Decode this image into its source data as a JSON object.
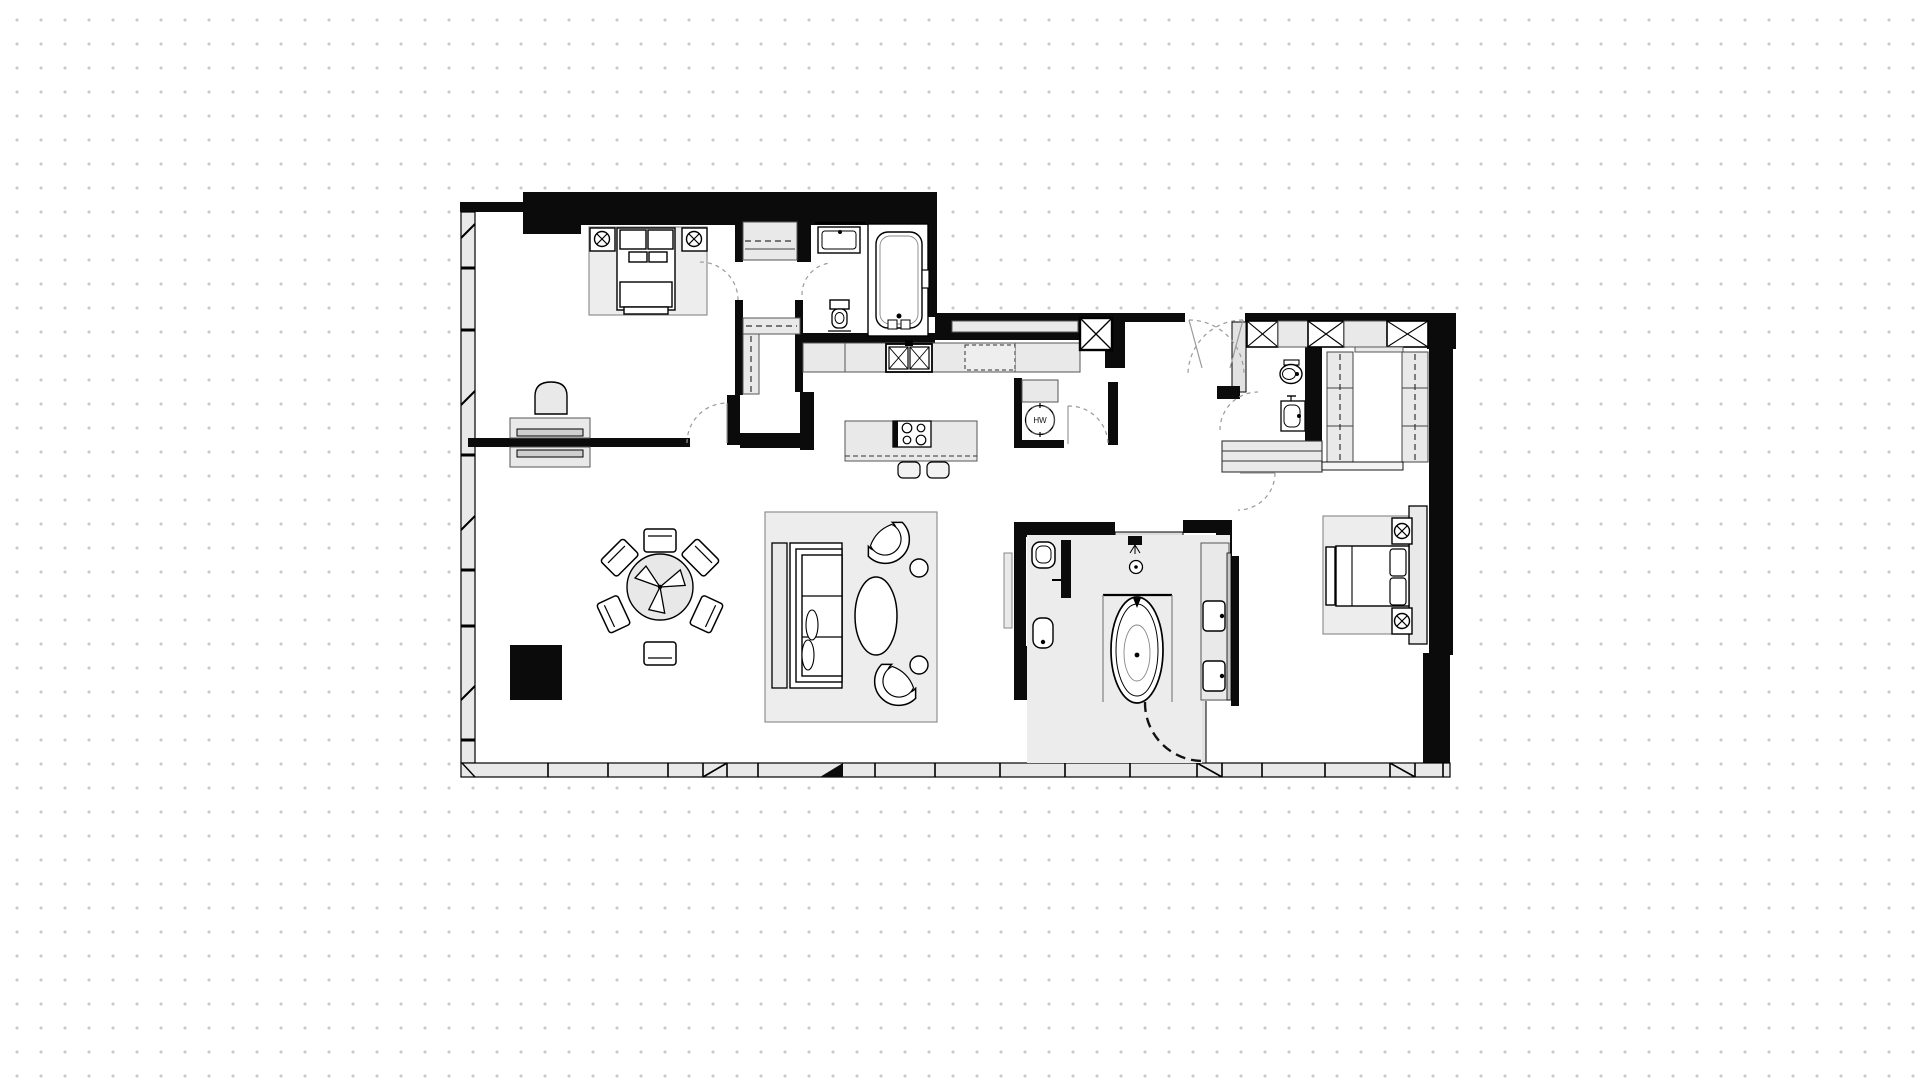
{
  "canvas": {
    "width": 1920,
    "height": 1078,
    "background_color": "#ffffff",
    "dot_grid": {
      "color": "#c9c9c9",
      "spacing_px": 24,
      "dot_size_px": 3
    }
  },
  "palette": {
    "wall": "#0b0b0b",
    "furniture_fill": "#e9e9e9",
    "rug_fill": "#ededed",
    "bath_floor_fill": "#ececec",
    "line": "#000000",
    "door_arc": "#9a9a9a"
  },
  "labels": {
    "hot_water": "HW"
  },
  "floor_plan": {
    "type": "apartment-floor-plan",
    "rooms": [
      {
        "name": "bedroom-1",
        "fixtures": [
          "double-bed",
          "two-nightstands-with-lamps",
          "area-rug",
          "desk-with-chair",
          "reach-in-closet",
          "walk-in-closet"
        ]
      },
      {
        "name": "ensuite-bathroom-1",
        "fixtures": [
          "vanity-sink",
          "toilet",
          "built-in-bathtub"
        ]
      },
      {
        "name": "kitchen",
        "fixtures": [
          "counter-run",
          "double-sink",
          "dishwasher",
          "island-with-cooktop",
          "two-stools",
          "hot-water-heater-closet"
        ]
      },
      {
        "name": "living-dining",
        "fixtures": [
          "round-dining-table-six-chairs",
          "fireplace-block",
          "sofa",
          "media-console",
          "oval-coffee-table",
          "two-barrel-chairs",
          "two-side-tables",
          "area-rug"
        ]
      },
      {
        "name": "foyer",
        "fixtures": [
          "double-entry-doors",
          "storage-row-with-x-boxes",
          "service-shaft"
        ]
      },
      {
        "name": "powder-room",
        "fixtures": [
          "wall-hung-toilet",
          "small-sink"
        ]
      },
      {
        "name": "dressing-room",
        "fixtures": [
          "two-wardrobe-columns",
          "hall-cabinet"
        ]
      },
      {
        "name": "master-bathroom",
        "fixtures": [
          "freestanding-oval-tub",
          "rain-shower",
          "double-vanity",
          "toilet",
          "bidet",
          "curved-glass-door"
        ]
      },
      {
        "name": "bedroom-2",
        "fixtures": [
          "double-bed",
          "two-nightstands-with-lamps",
          "area-rug",
          "headboard-wall"
        ]
      }
    ],
    "window_walls": [
      "left-facade",
      "bottom-facade"
    ]
  }
}
